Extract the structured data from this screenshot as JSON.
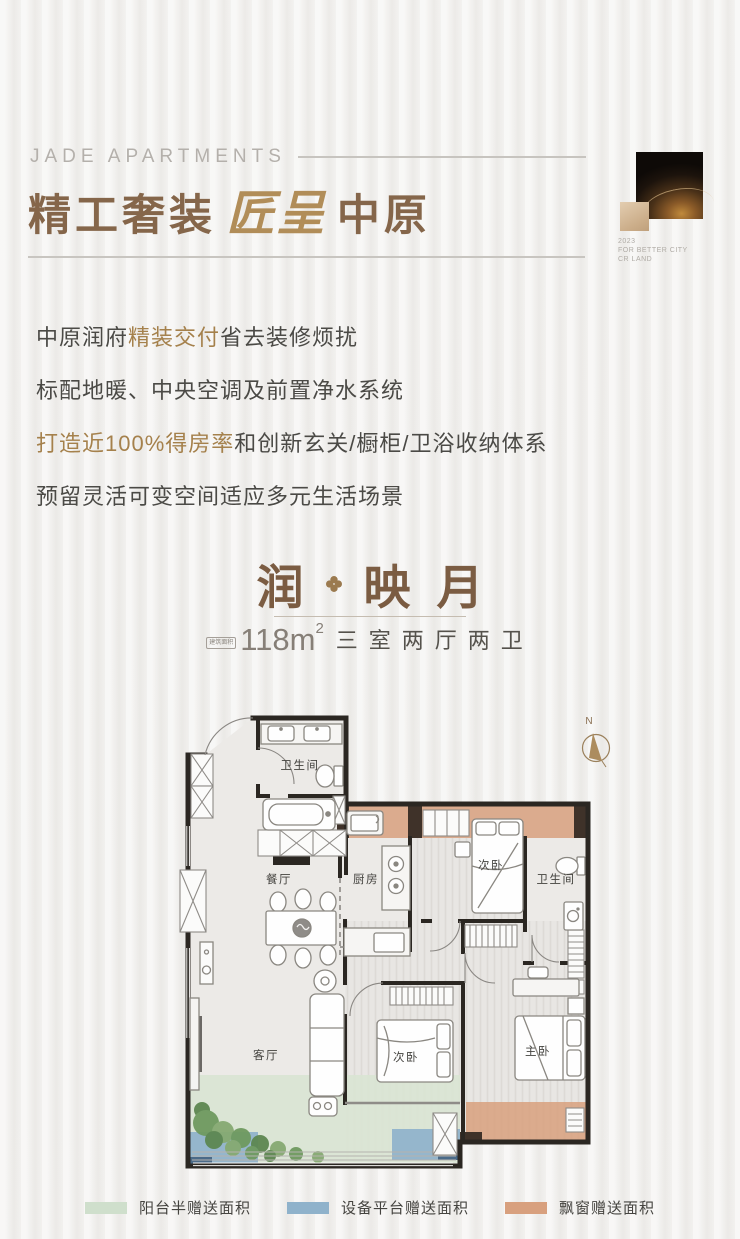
{
  "poster": {
    "brand": "JADE APARTMENTS",
    "headline": {
      "left": "精工奢装",
      "script": "匠呈",
      "right": "中原"
    },
    "badge": {
      "year": "2023",
      "slogan": "FOR BETTER CITY",
      "company": "CR LAND"
    },
    "selling_points": {
      "p1_a": "中原润府",
      "p1_hl": "精装交付",
      "p1_b": "省去装修烦扰",
      "p2": "标配地暖、中央空调及前置净水系统",
      "p3_hl": "打造近100%得房率",
      "p3_b": "和创新玄关/橱柜/卫浴收纳体系",
      "p4": "预留灵活可变空间适应多元生活场景"
    },
    "unit": {
      "name_first": "润",
      "name_rest": "映月",
      "area_tag": "建筑面积",
      "area_value": "118m",
      "area_sup": "2",
      "rooms_summary": "三室两厅两卫"
    }
  },
  "floorplan": {
    "compass_label": "N",
    "rooms": [
      {
        "label": "卫生间"
      },
      {
        "label": "餐厅"
      },
      {
        "label": "厨房"
      },
      {
        "label": "次卧"
      },
      {
        "label": "卫生间"
      },
      {
        "label": "客厅"
      },
      {
        "label": "次卧"
      },
      {
        "label": "主卧"
      }
    ],
    "legend": [
      {
        "label": "阳台半赠送面积",
        "color": "#cfdfcc"
      },
      {
        "label": "设备平台赠送面积",
        "color": "#8fb2cb"
      },
      {
        "label": "飘窗赠送面积",
        "color": "#d8a07e"
      }
    ]
  },
  "colors": {
    "accent_gold": "#a5814c",
    "title_brown": "#85664a",
    "script_gold": "#b18d58",
    "body_text": "#4b4a46",
    "unit_name_brown": "#7b5c42",
    "bay_window_zone": "#d8a07e",
    "balcony_zone": "#d9e4d3",
    "equipment_zone": "#8fb2cb",
    "wall": "#2b2722"
  }
}
